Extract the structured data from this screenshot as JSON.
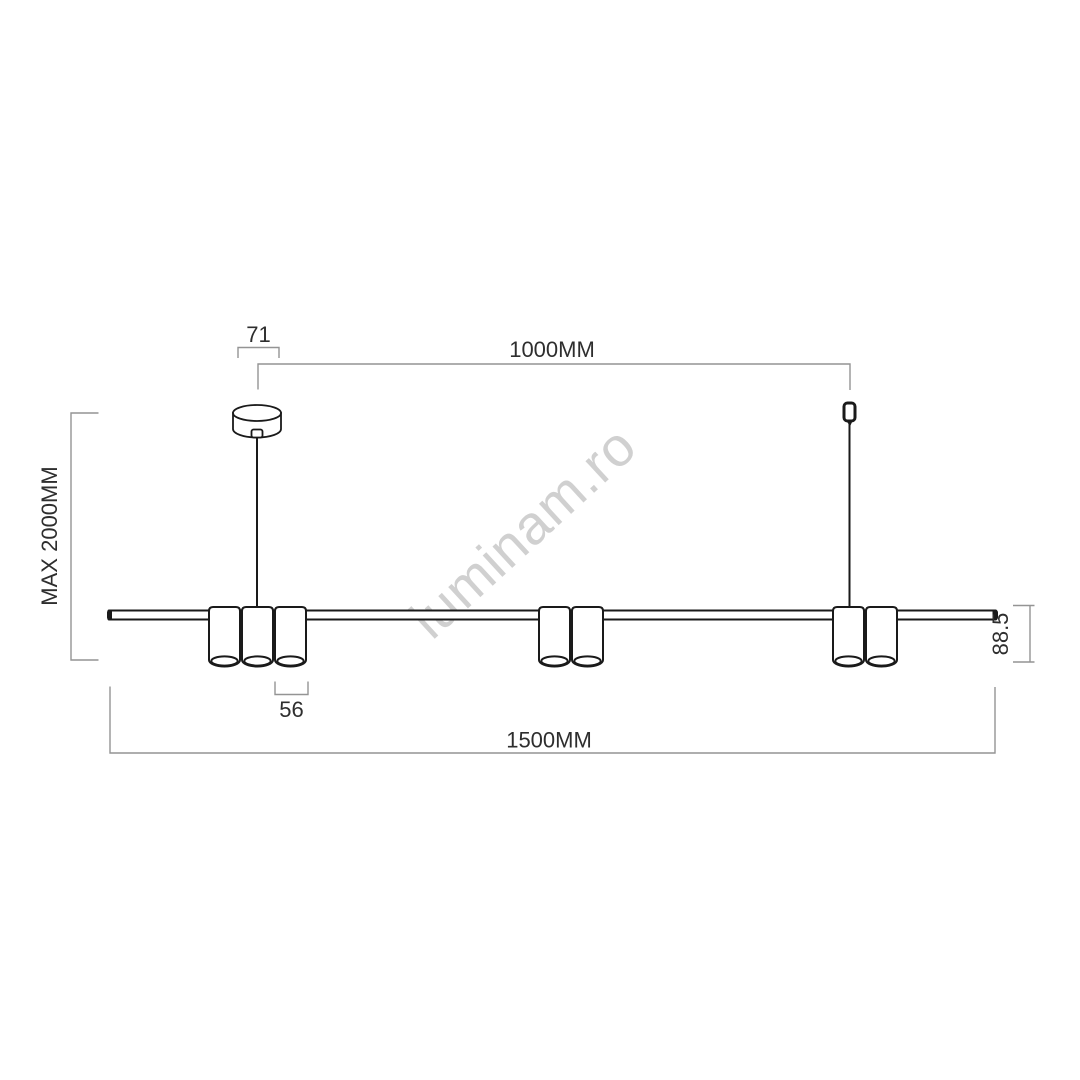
{
  "page": {
    "background": "#ffffff"
  },
  "watermark": {
    "text": "luminam.ro",
    "color": "#cbcbcb"
  },
  "colors": {
    "drawing_line": "#1a1a1a",
    "dimension_line": "#949494",
    "dimension_text": "#2e2e2e"
  },
  "dimensions": {
    "canopy_width": "71",
    "suspension_span": "1000MM",
    "max_height": "MAX 2000MM",
    "body_height": "88.5",
    "spot_diameter": "56",
    "total_length": "1500MM"
  }
}
